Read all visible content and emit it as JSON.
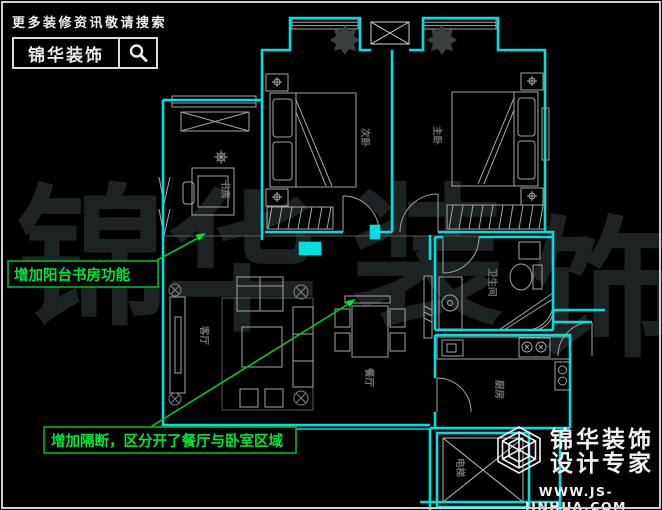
{
  "brand_badge": {
    "tagline": "更多装修资讯敬请搜索",
    "brand": "锦华装饰",
    "search_icon": "magnifier"
  },
  "watermark": {
    "char1": "锦",
    "char2": "华",
    "char3": "装",
    "char4": "饰"
  },
  "floor_plan": {
    "rooms": [
      {
        "name": "书房"
      },
      {
        "name": "次卧"
      },
      {
        "name": "主卧"
      },
      {
        "name": "客厅"
      },
      {
        "name": "餐厅"
      },
      {
        "name": "卫生间"
      },
      {
        "name": "厨房"
      },
      {
        "name": "电梯"
      }
    ]
  },
  "annotations": {
    "balcony_note": "增加阳台书房功能",
    "partition_note": "增加隔断，区分开了餐厅与卧室区域"
  },
  "footer_logo": {
    "brand": "锦华装饰",
    "subtitle": "设计专家",
    "website": "WWW.JS-JINHUA.COM",
    "icon": "wireframe-cube"
  },
  "icons": {
    "search": "magnifier-icon",
    "logo": "wireframe-cube-icon"
  },
  "colors": {
    "background": "#000000",
    "wall": "#00dfe0",
    "furniture": "#a9b0b0",
    "annotation_green": "#00d936",
    "watermark": "#1d2223",
    "white": "#eeeeee"
  }
}
